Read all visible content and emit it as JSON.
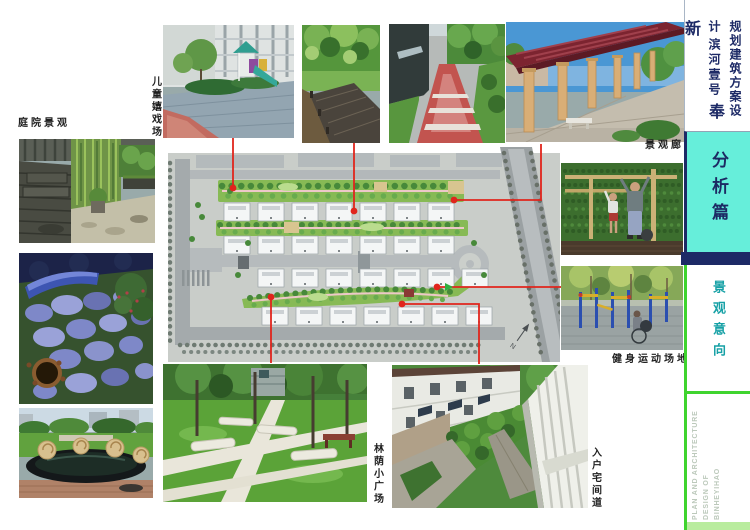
{
  "board": {
    "title_vertical": {
      "doc_type": "规划建筑方案设计",
      "project_subtitle": "滨河壹号",
      "project_name": "奉新"
    },
    "section": {
      "label": "分析篇"
    },
    "subsection": {
      "label": "景观意向"
    },
    "footer": {
      "lines": [
        "PLAN AND ARCHITECTURE",
        "DESIGN OF",
        "BINHEYIHAO"
      ]
    },
    "photo_labels": {
      "children_playground": "儿童嬉戏场",
      "courtyard_landscape": "庭院景观",
      "landscape_corridor": "景观廊",
      "fitness_ground": "健身运动场地",
      "shaded_plaza": "林荫小广场",
      "entrance_lane": "入户宅间道"
    },
    "plan": {
      "north_label": "N"
    },
    "colors": {
      "accent_teal": "#66eeda",
      "navy": "#1d2a66",
      "connector_red": "#e0251c",
      "line_green": "#3fd42e",
      "footer_band_green": "#b9ec9e"
    }
  }
}
